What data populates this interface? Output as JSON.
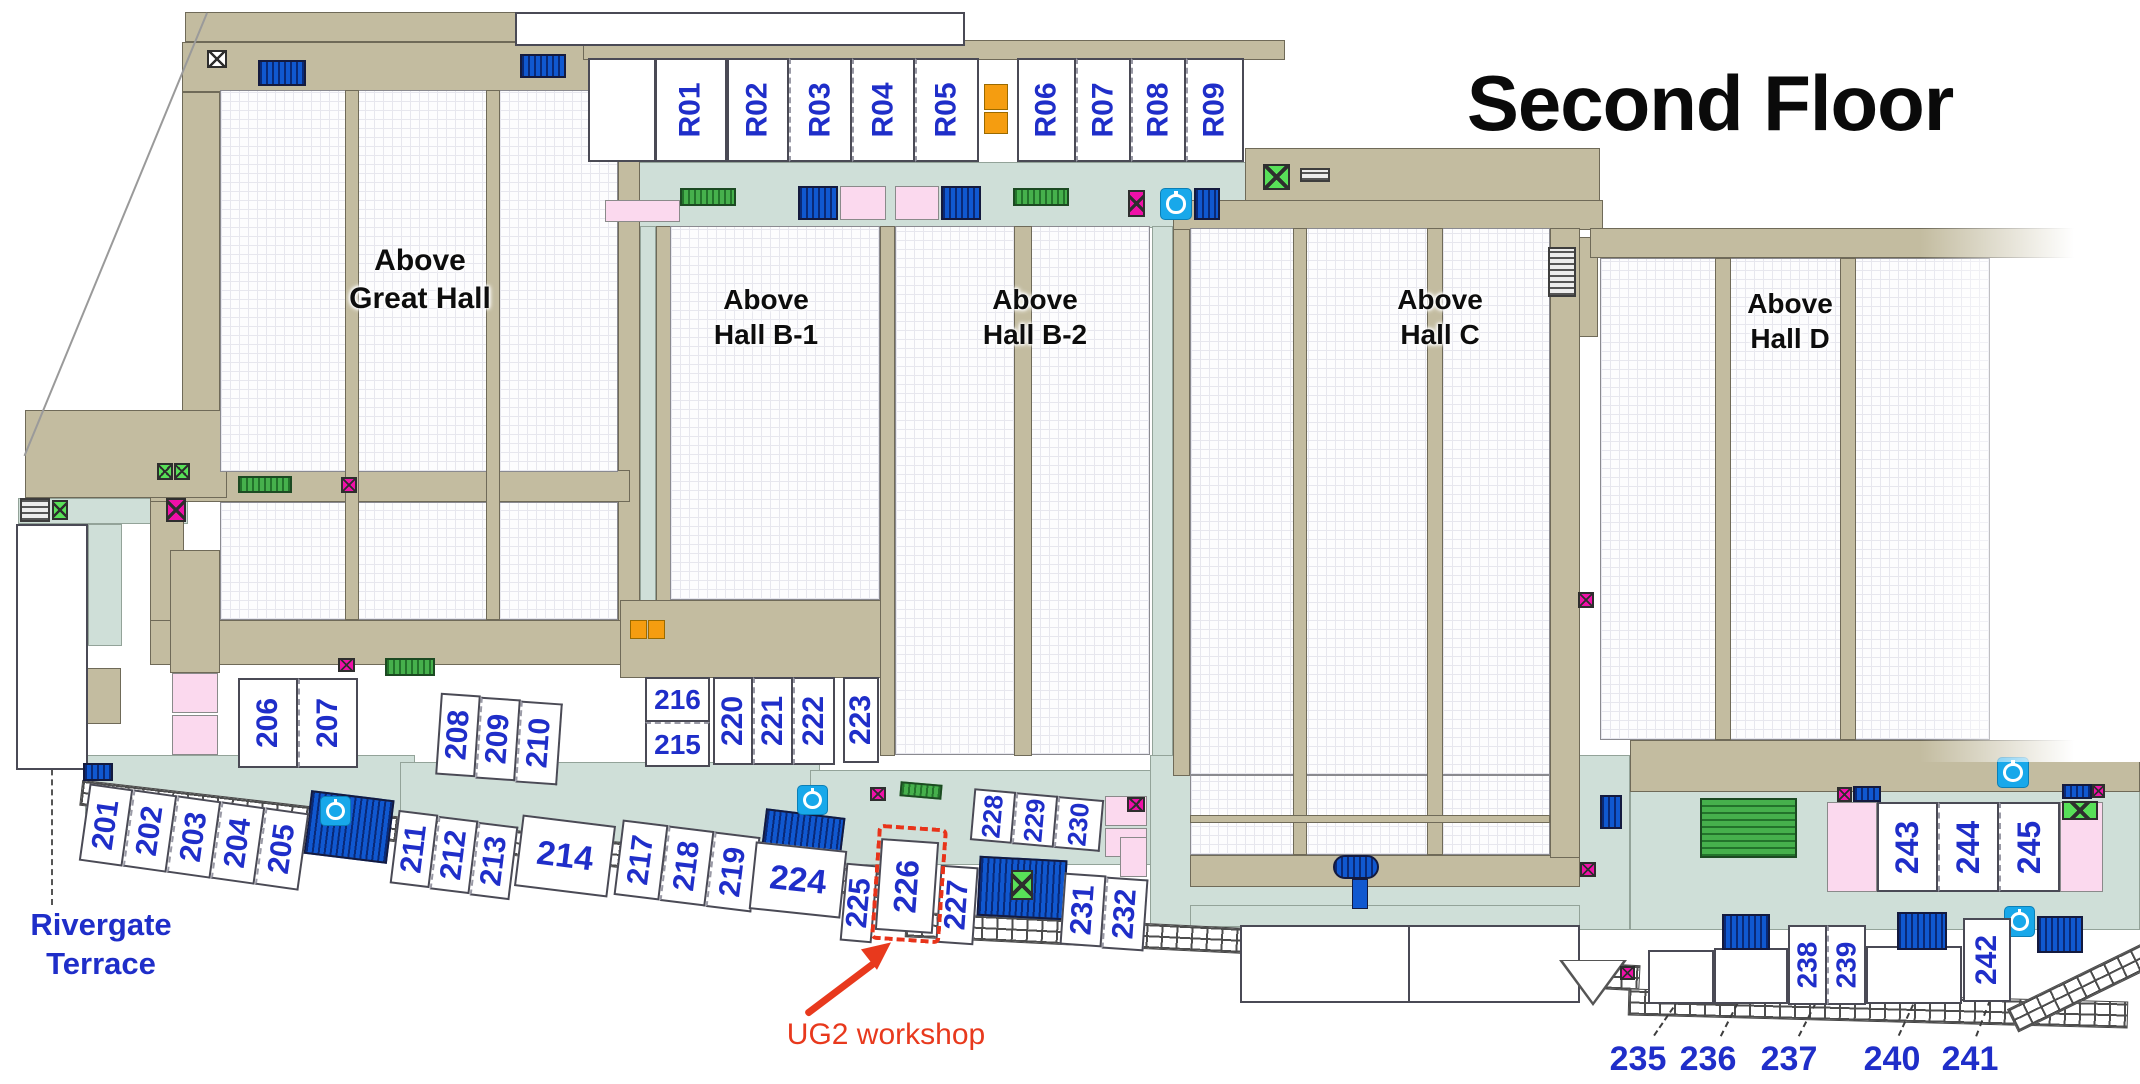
{
  "title": "Second Floor",
  "halls": [
    {
      "id": "great-hall",
      "name": "Above Great Hall",
      "lines": [
        "Above",
        "Great Hall"
      ]
    },
    {
      "id": "hall-b1",
      "name": "Above Hall B-1",
      "lines": [
        "Above",
        "Hall B-1"
      ]
    },
    {
      "id": "hall-b2",
      "name": "Above Hall B-2",
      "lines": [
        "Above",
        "Hall B-2"
      ]
    },
    {
      "id": "hall-c",
      "name": "Above Hall C",
      "lines": [
        "Above",
        "Hall C"
      ]
    },
    {
      "id": "hall-d",
      "name": "Above Hall D",
      "lines": [
        "Above",
        "Hall D"
      ]
    }
  ],
  "r_rooms": [
    {
      "id": "R01",
      "label": "R01"
    },
    {
      "id": "R02",
      "label": "R02"
    },
    {
      "id": "R03",
      "label": "R03"
    },
    {
      "id": "R04",
      "label": "R04"
    },
    {
      "id": "R05",
      "label": "R05"
    },
    {
      "id": "R06",
      "label": "R06"
    },
    {
      "id": "R07",
      "label": "R07"
    },
    {
      "id": "R08",
      "label": "R08"
    },
    {
      "id": "R09",
      "label": "R09"
    }
  ],
  "rooms": [
    {
      "id": "201",
      "label": "201"
    },
    {
      "id": "202",
      "label": "202"
    },
    {
      "id": "203",
      "label": "203"
    },
    {
      "id": "204",
      "label": "204"
    },
    {
      "id": "205",
      "label": "205"
    },
    {
      "id": "206",
      "label": "206"
    },
    {
      "id": "207",
      "label": "207"
    },
    {
      "id": "208",
      "label": "208"
    },
    {
      "id": "209",
      "label": "209"
    },
    {
      "id": "210",
      "label": "210"
    },
    {
      "id": "211",
      "label": "211"
    },
    {
      "id": "212",
      "label": "212"
    },
    {
      "id": "213",
      "label": "213"
    },
    {
      "id": "214",
      "label": "214"
    },
    {
      "id": "215",
      "label": "215"
    },
    {
      "id": "216",
      "label": "216"
    },
    {
      "id": "217",
      "label": "217"
    },
    {
      "id": "218",
      "label": "218"
    },
    {
      "id": "219",
      "label": "219"
    },
    {
      "id": "220",
      "label": "220"
    },
    {
      "id": "221",
      "label": "221"
    },
    {
      "id": "222",
      "label": "222"
    },
    {
      "id": "223",
      "label": "223"
    },
    {
      "id": "224",
      "label": "224"
    },
    {
      "id": "225",
      "label": "225"
    },
    {
      "id": "226",
      "label": "226"
    },
    {
      "id": "227",
      "label": "227"
    },
    {
      "id": "228",
      "label": "228"
    },
    {
      "id": "229",
      "label": "229"
    },
    {
      "id": "230",
      "label": "230"
    },
    {
      "id": "231",
      "label": "231"
    },
    {
      "id": "232",
      "label": "232"
    },
    {
      "id": "238",
      "label": "238"
    },
    {
      "id": "239",
      "label": "239"
    },
    {
      "id": "242",
      "label": "242"
    },
    {
      "id": "243",
      "label": "243"
    },
    {
      "id": "244",
      "label": "244"
    },
    {
      "id": "245",
      "label": "245"
    }
  ],
  "callouts": [
    {
      "id": "235",
      "label": "235"
    },
    {
      "id": "236",
      "label": "236"
    },
    {
      "id": "237",
      "label": "237"
    },
    {
      "id": "240",
      "label": "240"
    },
    {
      "id": "241",
      "label": "241"
    }
  ],
  "terrace": {
    "name": "Rivergate Terrace",
    "lines": [
      "Rivergate",
      "Terrace"
    ]
  },
  "annotation": {
    "text": "UG2 workshop",
    "target_room": "226"
  },
  "legend_icons": {
    "escalator": "escalator",
    "stairs": "stairs",
    "restroom": "restroom",
    "elevator": "elevator",
    "charging_station": "charging-station",
    "spiral_stair": "spiral-stair"
  },
  "colors": {
    "room_label": "#1f2ec9",
    "hall_label": "#0d0d0d",
    "wall_tan": "#c3bca0",
    "corridor": "#cfdfd8",
    "annotation_red": "#e8391d",
    "escalator_blue": "#1058d0",
    "stairs_green": "#46b04c",
    "restroom_pink": "#fbd9ee",
    "elevator_magenta": "#f010a8",
    "elevator_green": "#58e058",
    "charging_cyan": "#18a8ea",
    "orange_marker": "#f59d10"
  }
}
